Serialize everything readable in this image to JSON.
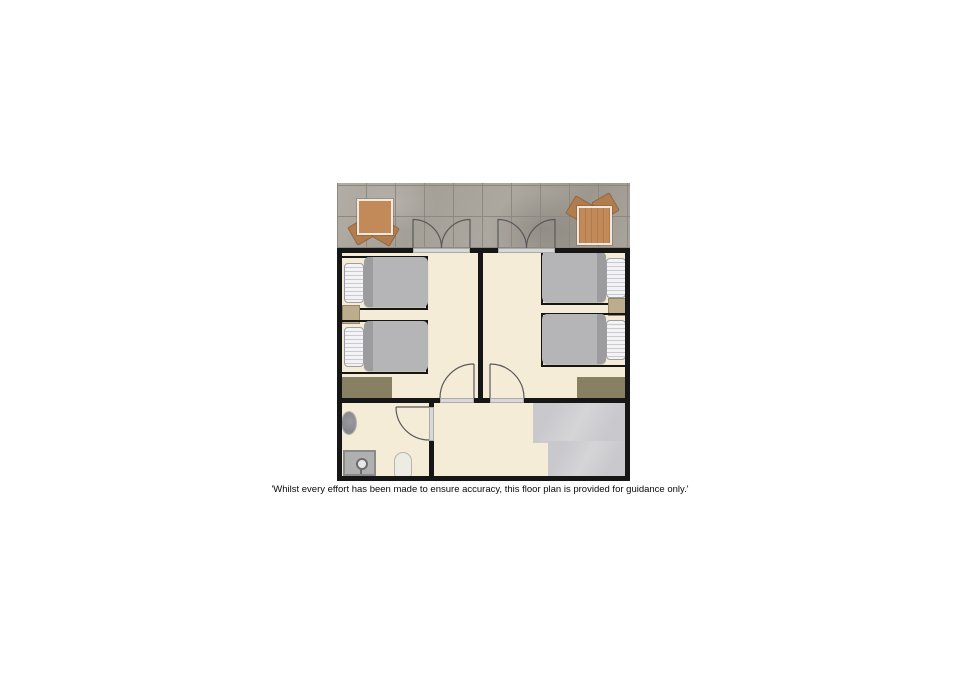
{
  "disclaimer": "'Whilst every effort has been made to ensure accuracy, this floor plan is provided for guidance only.'",
  "colors": {
    "wall": "#161616",
    "cream": "#f4ecd7",
    "deck_base": "#a9a49c",
    "deck_grout": "#8e897f",
    "gray_floor": "#c9c9cd",
    "table_wood": "#c28a58",
    "chair_wood": "#b17c4e",
    "blanket": "#b5b5b7",
    "blanket_fold": "#9c9c9e",
    "pillow": "#f3f3f5",
    "pillow_stripe": "#c9c9cf",
    "pillow_border": "#9d9da3",
    "rug": "#878063",
    "nightstand": "#bcad8c",
    "nightstand_border": "#94876a",
    "sill": "#d8d8d8",
    "door_arc": "#5a5a5a",
    "shower": "#b0b0b0",
    "shower_border": "#8a8a8a",
    "fixture": "#86868c",
    "toilet": "#edece3",
    "toilet_border": "#b5b5ad"
  }
}
